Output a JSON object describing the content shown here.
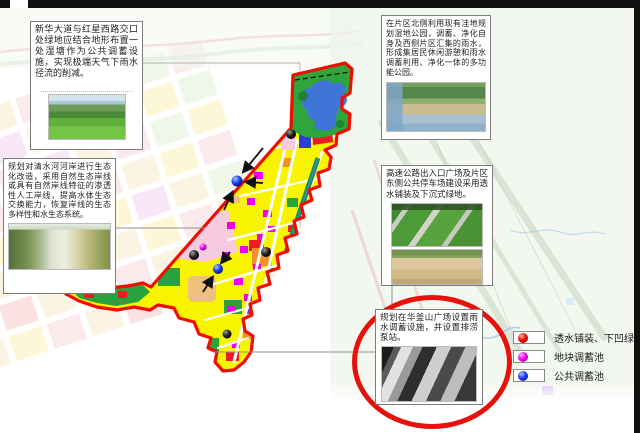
{
  "callouts": {
    "top_left": {
      "text": "新华大道与红星西路交口处绿地应结合地形布置一处湿塘作为公共调蓄设施，实现极端天气下雨水径流的削减。"
    },
    "left": {
      "text": "规划对清水河河岸进行生态化改造，采用自然生态岸线或具有自然岸线特征的渗透性人工岸线，提高水体生态交换能力，恢复岸线的生态多样性和水生态系统。"
    },
    "top_right": {
      "text": "在片区北侧利用现有洼地规划湿地公园，调蓄、净化自身及西侧片区汇集的雨水，形成集居民休闲游憩和雨水调蓄利用、净化一体的多功能公园。"
    },
    "right": {
      "text": "高速公路出入口广场及片区东侧公共停车场建设采用透水铺装及下沉式绿地。"
    },
    "circle": {
      "text": "规划在华釜山广场设置雨水调蓄设施，并设置排涝泵站。"
    }
  },
  "legend": {
    "items": [
      {
        "name": "permeable-paving-sunken-green",
        "label": "透水铺装、下凹绿地",
        "color": "#f20800"
      },
      {
        "name": "plot-storage-tank",
        "label": "地块调蓄池",
        "color": "#f202f2"
      },
      {
        "name": "public-storage-tank",
        "label": "公共调蓄池",
        "color": "#1a3cf0"
      }
    ]
  },
  "map": {
    "boundary_color": "#f10c00",
    "park_green": "#2fa53c",
    "lake_blue": "#3f74d8",
    "landuse_yellow": "#f8f400",
    "highlight_circle_color": "#e8100a"
  }
}
